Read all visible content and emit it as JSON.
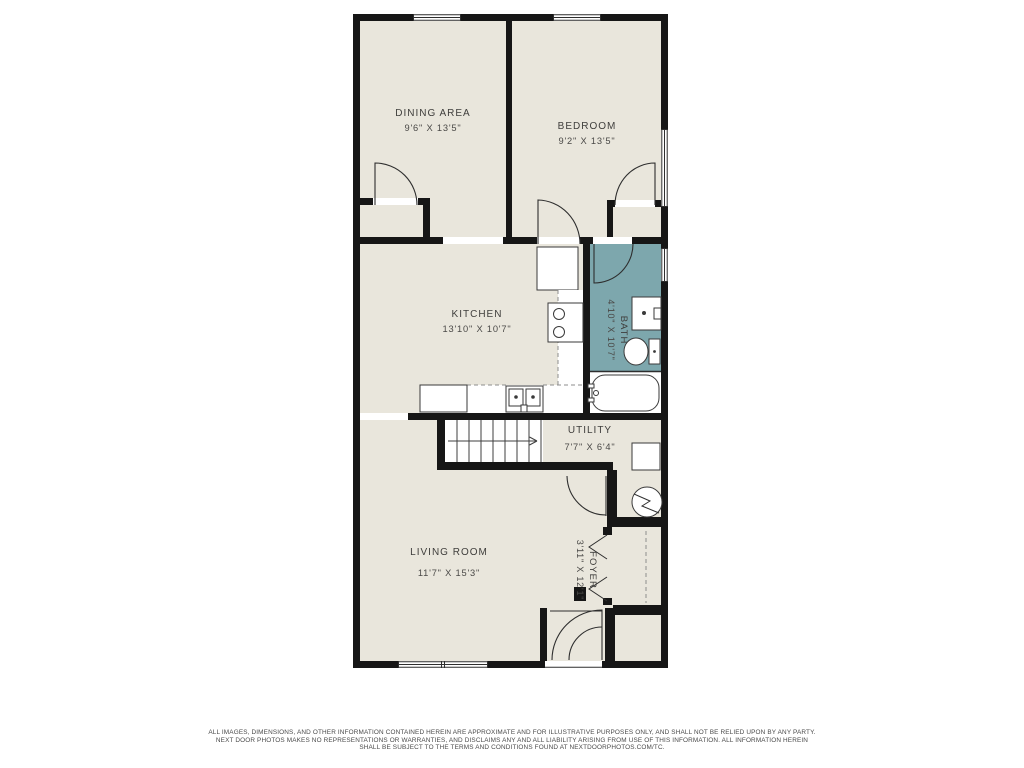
{
  "floor_plan": {
    "wall_color": "#161616",
    "floor_color": "#e9e6dc",
    "bath_color": "#7da7ad",
    "rooms": {
      "dining": {
        "name": "DINING AREA",
        "dims": "9'6\" X 13'5\""
      },
      "bedroom": {
        "name": "BEDROOM",
        "dims": "9'2\" X 13'5\""
      },
      "kitchen": {
        "name": "KITCHEN",
        "dims": "13'10\" X 10'7\""
      },
      "bath": {
        "name": "BATH",
        "dims": "4'10\" X 10'7\""
      },
      "utility": {
        "name": "UTILITY",
        "dims": "7'7\" X 6'4\""
      },
      "living": {
        "name": "LIVING ROOM",
        "dims": "11'7\" X 15'3\""
      },
      "foyer": {
        "name": "FOYER",
        "dims": "3'11\" X 12'1\""
      }
    }
  },
  "disclaimer": {
    "line1": "ALL IMAGES, DIMENSIONS, AND OTHER INFORMATION CONTAINED HEREIN ARE APPROXIMATE AND FOR ILLUSTRATIVE PURPOSES ONLY, AND SHALL NOT BE RELIED UPON BY ANY PARTY.",
    "line2": "NEXT DOOR PHOTOS MAKES NO REPRESENTATIONS OR WARRANTIES, AND DISCLAIMS ANY AND ALL LIABILITY ARISING FROM USE OF THIS INFORMATION. ALL INFORMATION HEREIN",
    "line3": "SHALL BE SUBJECT TO THE TERMS AND CONDITIONS FOUND AT NEXTDOORPHOTOS.COM/TC."
  }
}
